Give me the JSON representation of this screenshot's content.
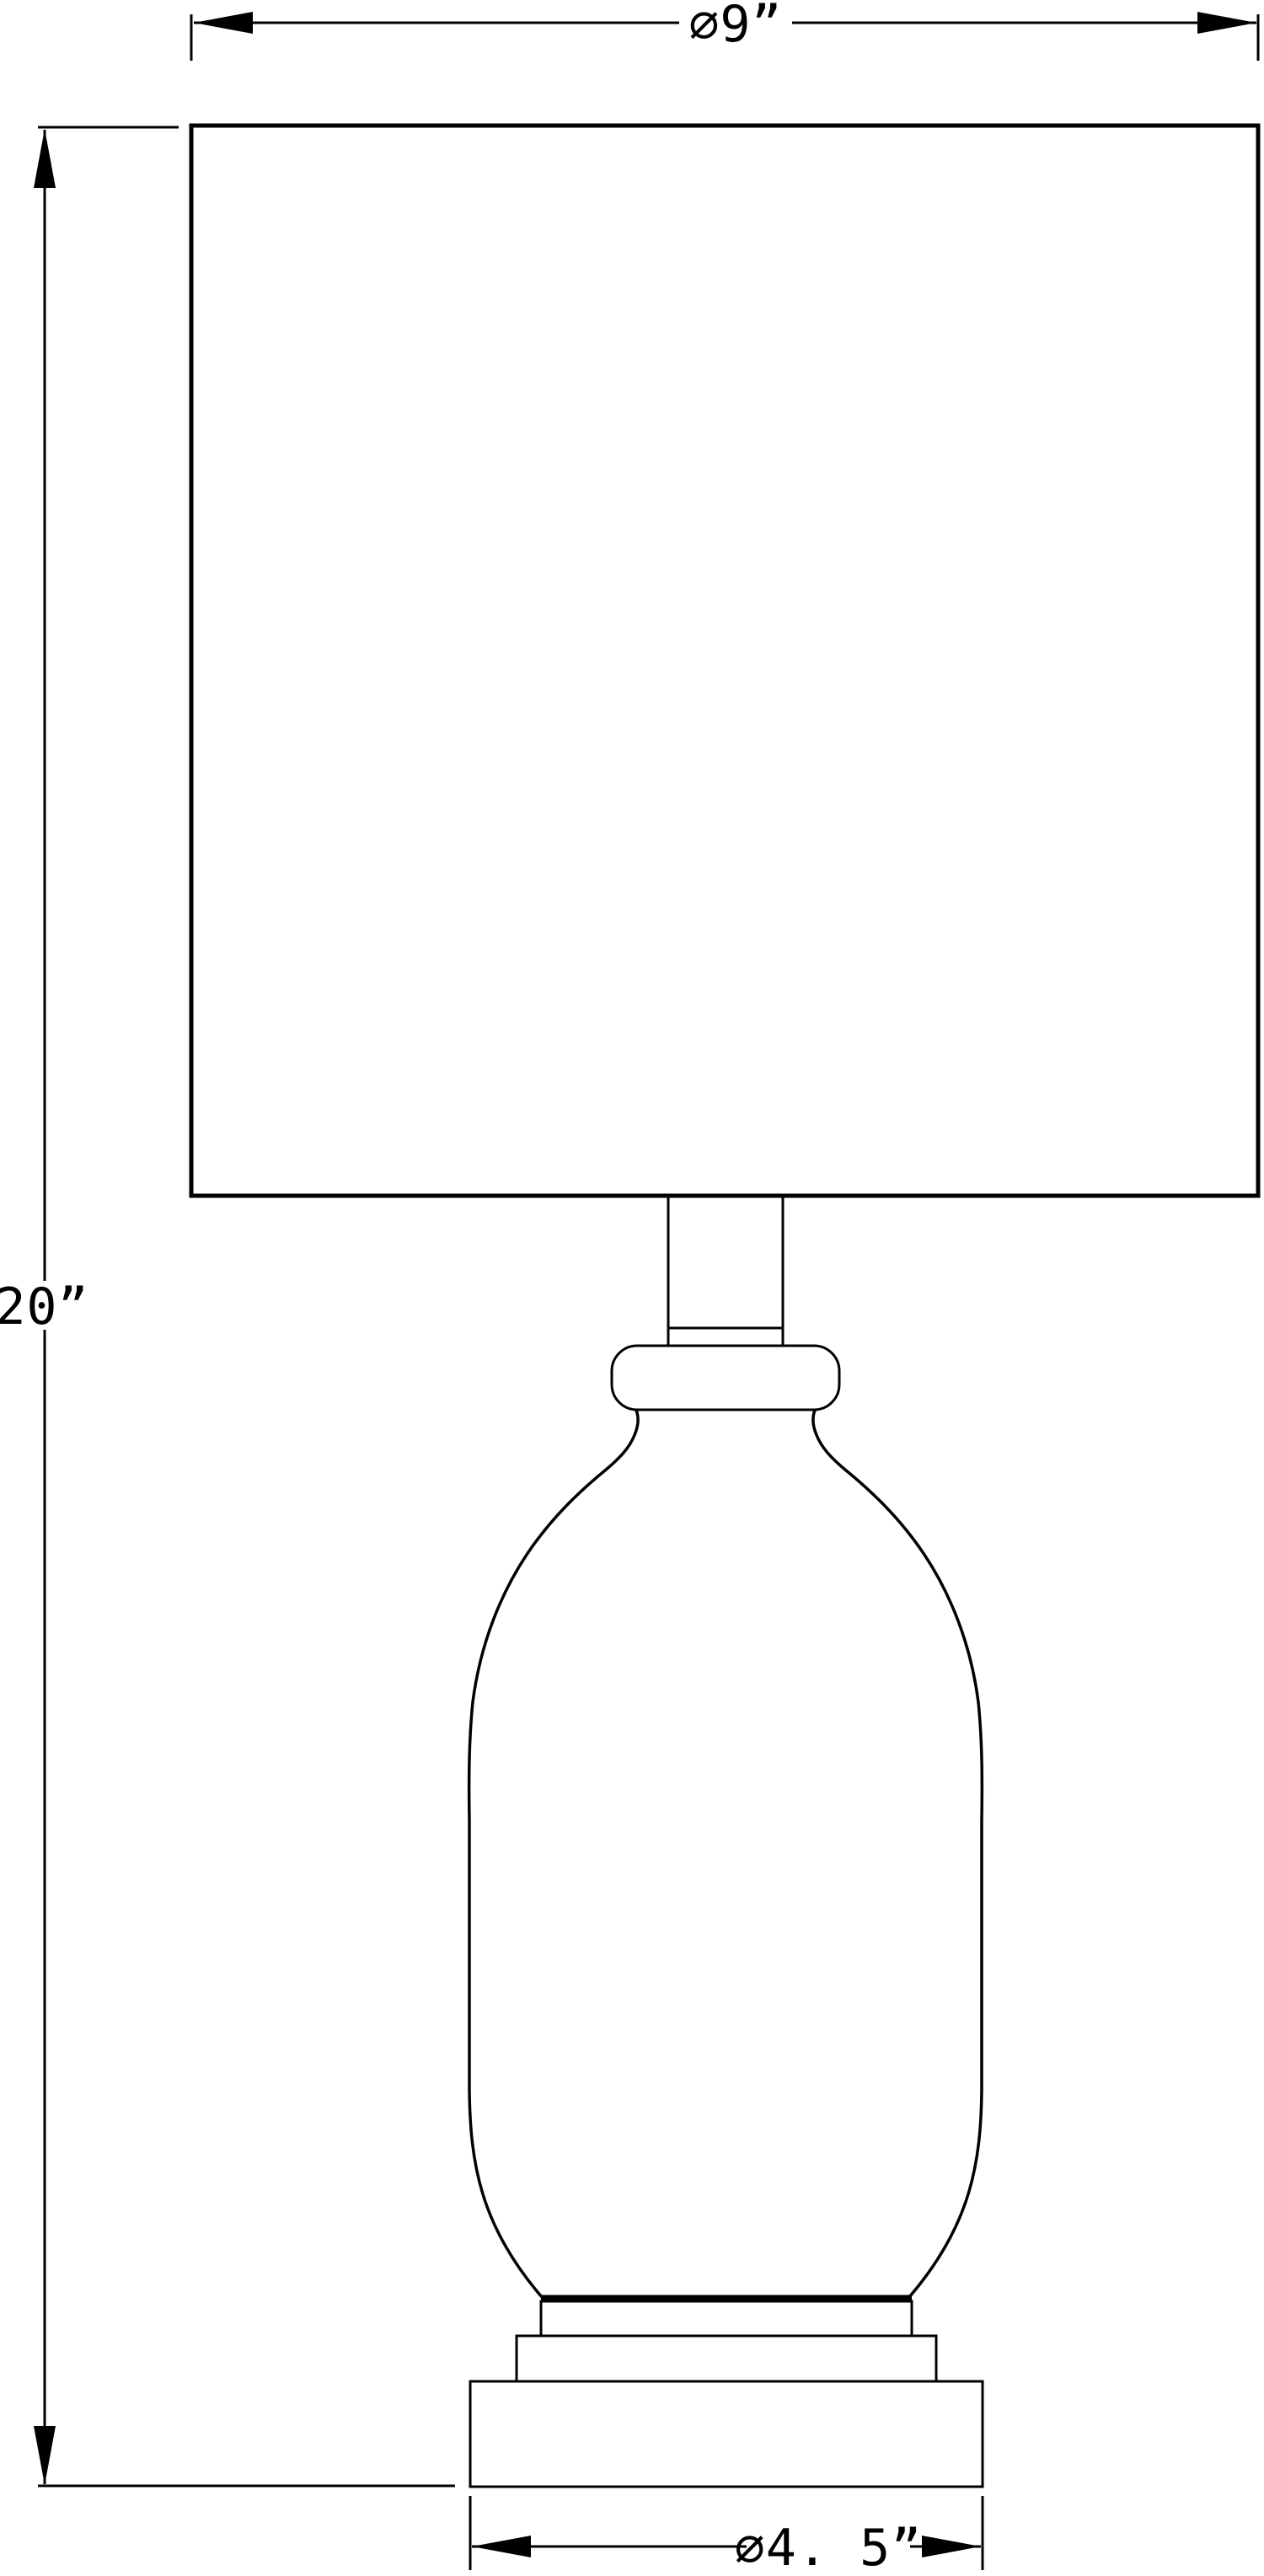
{
  "drawing": {
    "type": "technical-dimension-drawing",
    "subject": "table-lamp-front-elevation",
    "background_color": "#ffffff",
    "line_color": "#000000",
    "dimensions": {
      "shade_diameter": {
        "label": "∅9”",
        "value": 9,
        "unit": "inches",
        "location": "top"
      },
      "overall_height": {
        "label": "20”",
        "value": 20,
        "unit": "inches",
        "location": "left"
      },
      "base_diameter": {
        "label": "∅4. 5”",
        "value": 4.5,
        "unit": "inches",
        "location": "bottom"
      }
    }
  }
}
